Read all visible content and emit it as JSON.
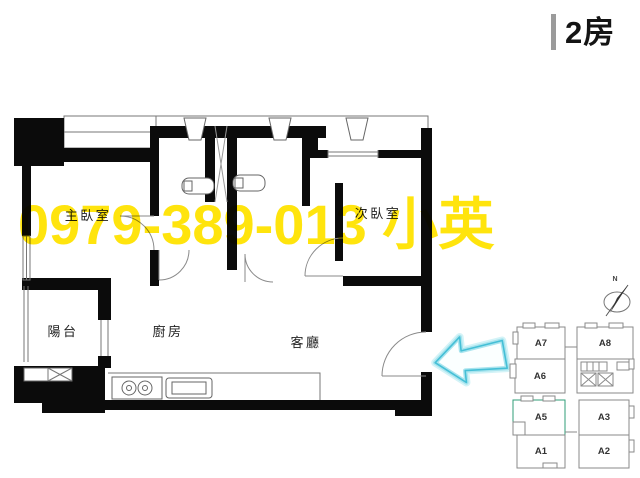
{
  "header": {
    "title": "2房"
  },
  "watermark": {
    "text": "0979-389-013 小英",
    "color": "#ffe40d"
  },
  "floorplan": {
    "rooms": {
      "master": "主臥室",
      "second": "次臥室",
      "balcony": "陽台",
      "kitchen": "廚房",
      "living": "客廳"
    }
  },
  "minimap": {
    "compass": "N",
    "highlight_color": "#57dcaa",
    "highlighted_unit": "A5",
    "units": {
      "a7": "A7",
      "a8": "A8",
      "a6": "A6",
      "a5": "A5",
      "a3": "A3",
      "a1": "A1",
      "a2": "A2"
    }
  },
  "arrow": {
    "direction": "left",
    "color": "#5ecbdd"
  }
}
